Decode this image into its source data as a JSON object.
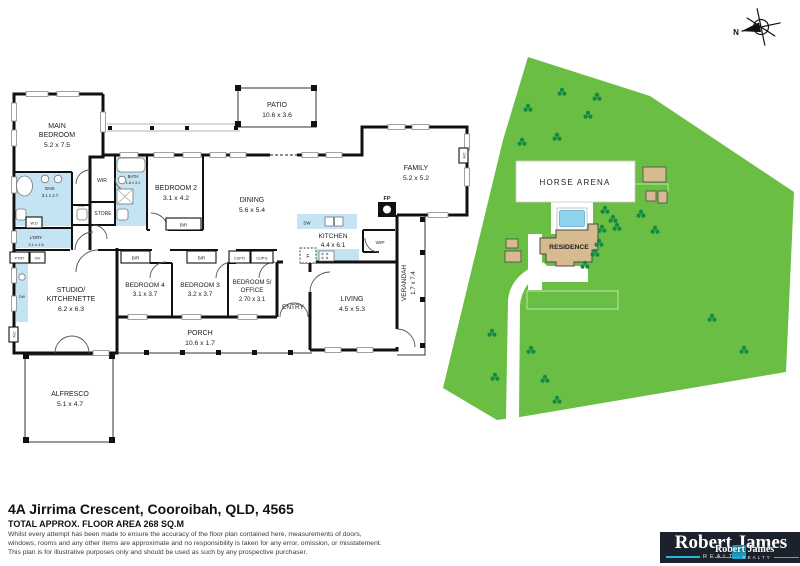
{
  "floor_plan": {
    "rooms": {
      "main_bedroom": {
        "line1": "MAIN",
        "line2": "BEDROOM",
        "dims": "5.2 x 7.5"
      },
      "bedroom2": {
        "name": "BEDROOM 2",
        "dims": "3.1 x 4.2"
      },
      "bedroom3": {
        "name": "BEDROOM 3",
        "dims": "3.2 x 3.7"
      },
      "bedroom4": {
        "name": "BEDROOM 4",
        "dims": "3.1 x 3.7"
      },
      "bedroom5": {
        "line1": "BEDROOM 5/",
        "line2": "OFFICE",
        "dims": "2.70 x 3.1"
      },
      "dining": {
        "name": "DINING",
        "dims": "5.6 x 5.4"
      },
      "patio": {
        "name": "PATIO",
        "dims": "10.6 x 3.6"
      },
      "family": {
        "name": "FAMILY",
        "dims": "5.2 x 5.2"
      },
      "kitchen": {
        "name": "KITCHEN",
        "dims": "4.4 x 6.1"
      },
      "living": {
        "name": "LIVING",
        "dims": "4.5 x 5.3"
      },
      "studio": {
        "line1": "STUDIO/",
        "line2": "KITCHENETTE",
        "dims": "6.2 x 6.3"
      },
      "entry": {
        "name": "ENTRY"
      },
      "porch": {
        "name": "PORCH",
        "dims": "10.6 x 1.7"
      },
      "alfresco": {
        "name": "ALFRESCO",
        "dims": "5.1 x 4.7"
      },
      "verandah": {
        "name": "VERANDAH",
        "dims": "1.7 x 7.4"
      },
      "ens": {
        "name": "ENS",
        "dims": "3.1 x 2.7"
      },
      "bath": {
        "name": "BATH",
        "dims": "1.8 x 3.1"
      },
      "laundry": {
        "name": "L'DRY",
        "dims": "3.1 x 1.6"
      }
    },
    "fixtures": {
      "wir": "WIR",
      "store": "STORE",
      "toilet": "TOIL",
      "washer_dryer": "W.D",
      "pantry": "P'TRY",
      "oven": "OV",
      "dishwasher": "DW",
      "fridge": "F",
      "walk_in_pantry": "WIP",
      "fireplace": "FP",
      "built_in_robe": "BIR",
      "cupboard": "CUP'D",
      "air_con": "A/C"
    }
  },
  "site_plan": {
    "horse_arena": "HORSE ARENA",
    "residence": "RESIDENCE"
  },
  "compass": {
    "north": "N"
  },
  "footer": {
    "address": "4A Jirrima Crescent, Cooroibah, QLD, 4565",
    "area": "TOTAL APPROX. FLOOR AREA 268 SQ.M",
    "disclaimer_lines": [
      "Whilst every attempt has been made to ensure the accuracy of the floor plan contained here, measurements of doors,",
      "windows, rooms and any other items are approximate and no responsibility is taken for any error, omission, or misstatement.",
      "This plan is for illustrative purposes only and should be used as such by any prospective purchaser."
    ]
  },
  "logo": {
    "brand": "Robert James",
    "tagline": "REALTY"
  },
  "colors": {
    "wet_area": "#c4e4f3",
    "site_green": "#6abe43",
    "tree_green": "#118a43",
    "building_tan": "#d6ba90",
    "pool_blue": "#8fd2ec",
    "logo_navy": "#1b222c",
    "logo_cyan": "#25b6d9"
  }
}
